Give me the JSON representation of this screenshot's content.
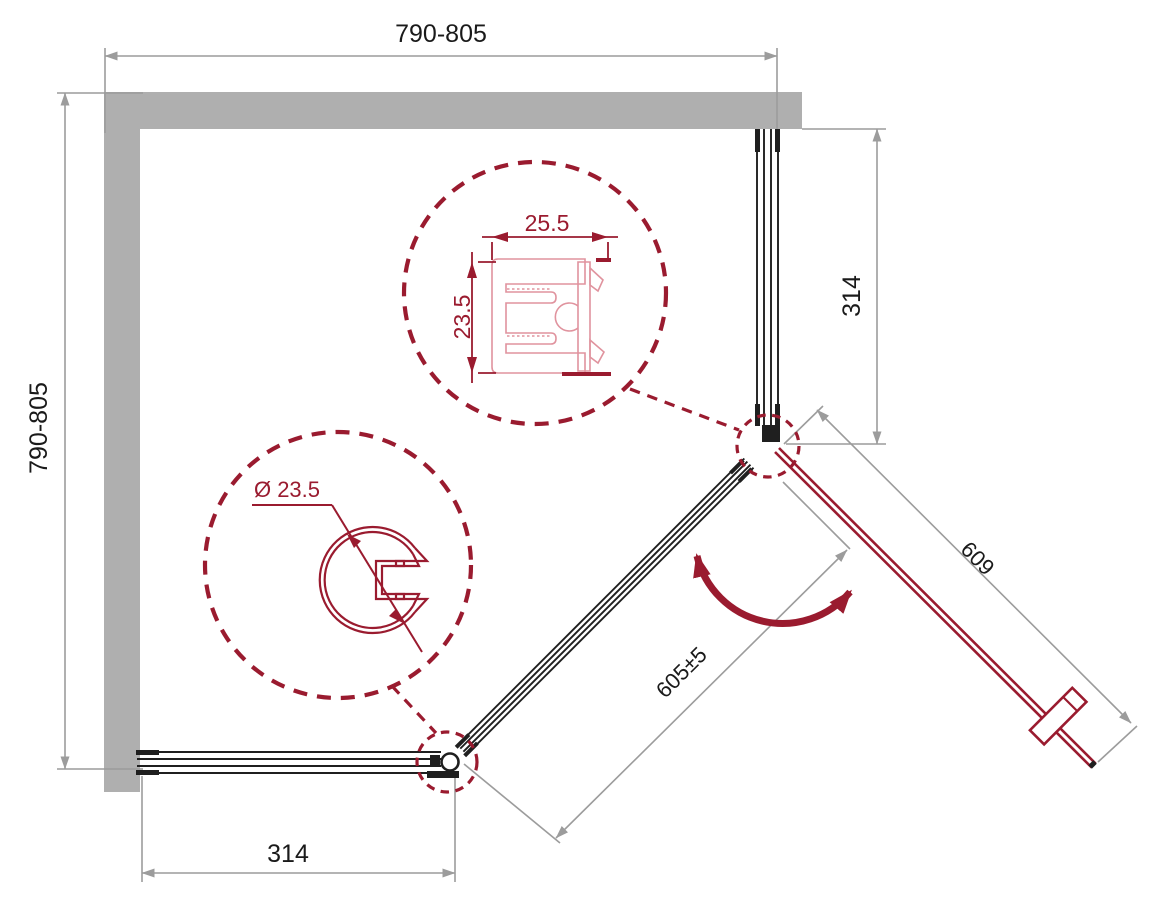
{
  "drawing": {
    "type": "shower-enclosure-corner-entry-plan",
    "dimensions": {
      "top_width": "790-805",
      "left_depth": "790-805",
      "right_panel": "314",
      "bottom_panel": "314",
      "entry_opening": "605±5",
      "door": "609"
    },
    "profile_detail": {
      "width": "25.5",
      "depth": "23.5"
    },
    "round_profile_detail": {
      "diameter": "Ø 23.5"
    },
    "colors": {
      "accent_maroon": "#9a1b2f",
      "profile_light": "#e0939e",
      "wall_gray": "#afafaf",
      "dim_gray": "#9c9c9c",
      "line_black": "#1f1f1f",
      "text_black": "#1a1a1a"
    }
  }
}
